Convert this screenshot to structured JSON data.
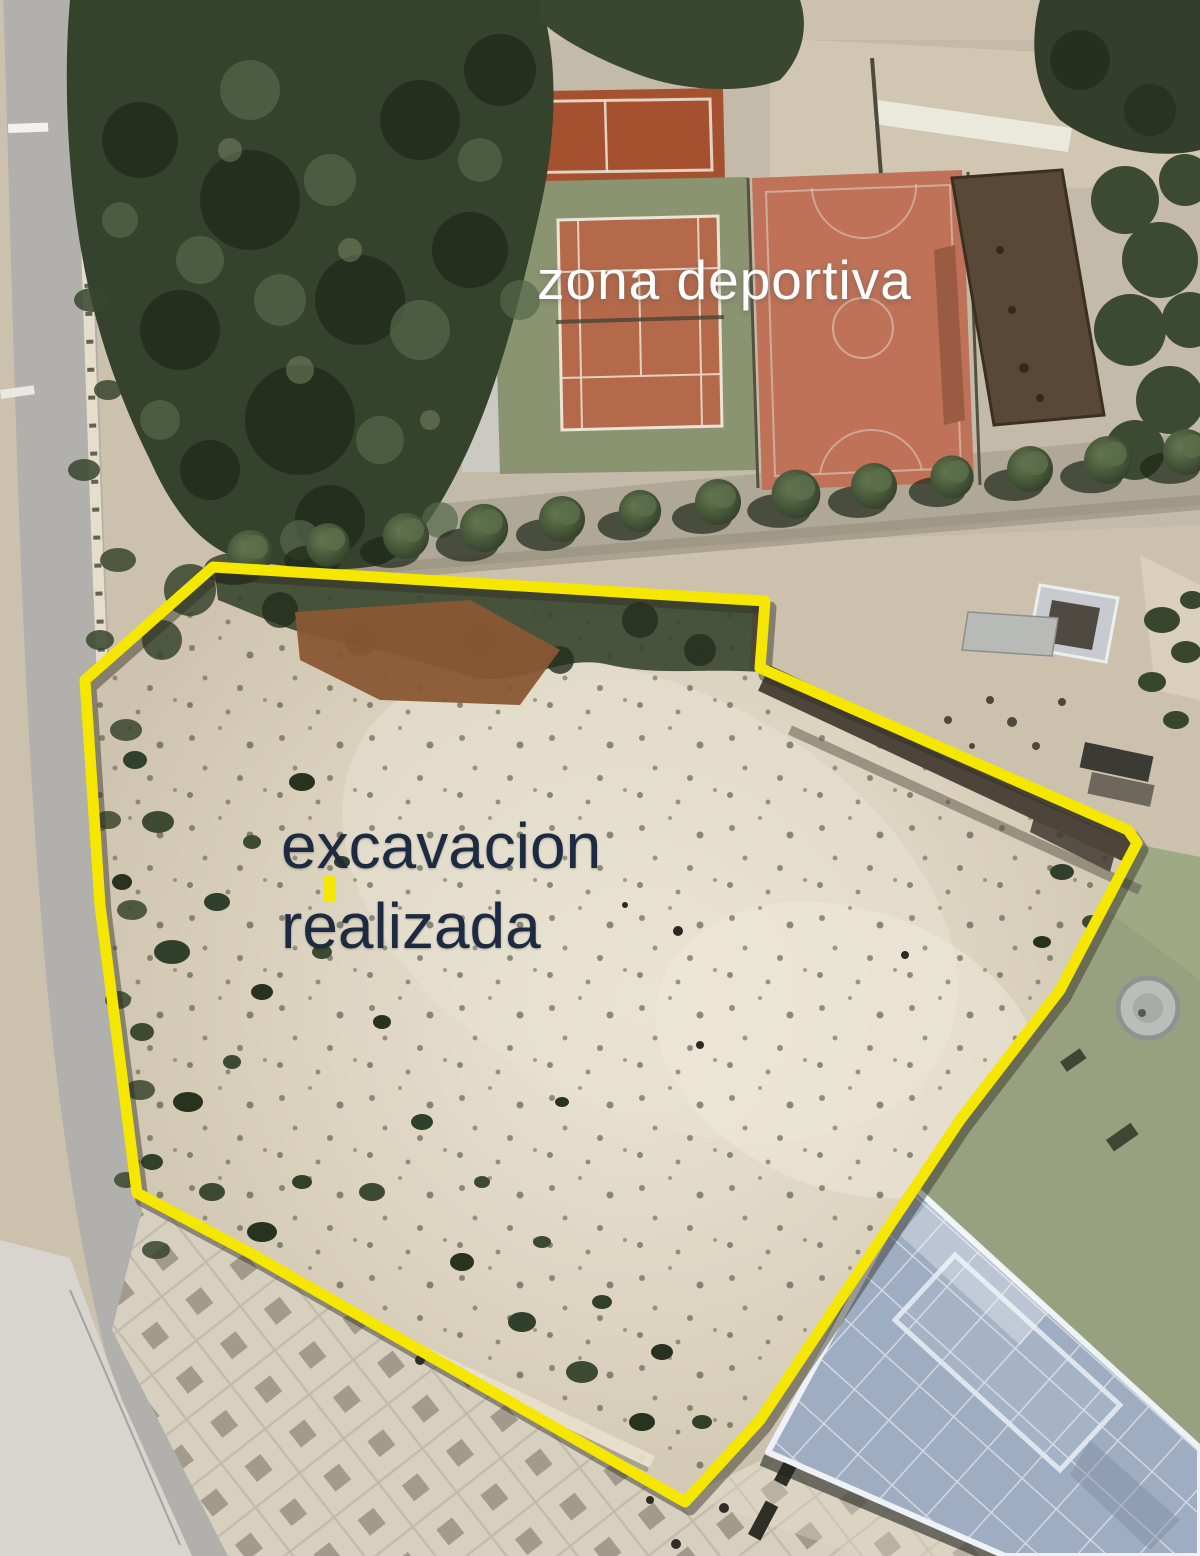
{
  "image": {
    "description": "Aerial satellite photograph annotated with a yellow boundary around an excavated plot, next to a sports area"
  },
  "labels": {
    "sports_zone": "zona deportiva",
    "excavation_line1": "excavacion",
    "excavation_line2": "realizada"
  },
  "annotation": {
    "boundary_color": "#f6e700",
    "boundary_points": "213,567 765,601 760,668 1128,830 1137,843 1060,990 960,1120 860,1270 760,1420 685,1502 250,1253 137,1193 100,905 85,680",
    "marker_dash_color": "#f6e700"
  },
  "palette": {
    "boundary_yellow": "#f6e700",
    "sports_label_text": "#ffffff",
    "excavation_label_text": "#1c2b41",
    "clay_court": "#b4694a",
    "tennis_surround": "#8b9471",
    "basketball_court": "#bf7257",
    "building_roof": "#5a4836",
    "trees": "#35422c",
    "excavation_dirt": "#d9d0bd",
    "road": "#b2b0ac",
    "plaza_tiles": "#d8d0bf",
    "glass_roof": "#9fadc2",
    "field_green": "#97a17f"
  },
  "features": [
    "road",
    "tree-grove",
    "padel-court",
    "tennis-court",
    "basketball-court",
    "roof-building",
    "tree-lined-path",
    "excavation-site",
    "retaining-wall",
    "terrace",
    "storage-containers",
    "green-field",
    "round-pool",
    "glass-roof-building",
    "tiled-plaza",
    "benches"
  ]
}
